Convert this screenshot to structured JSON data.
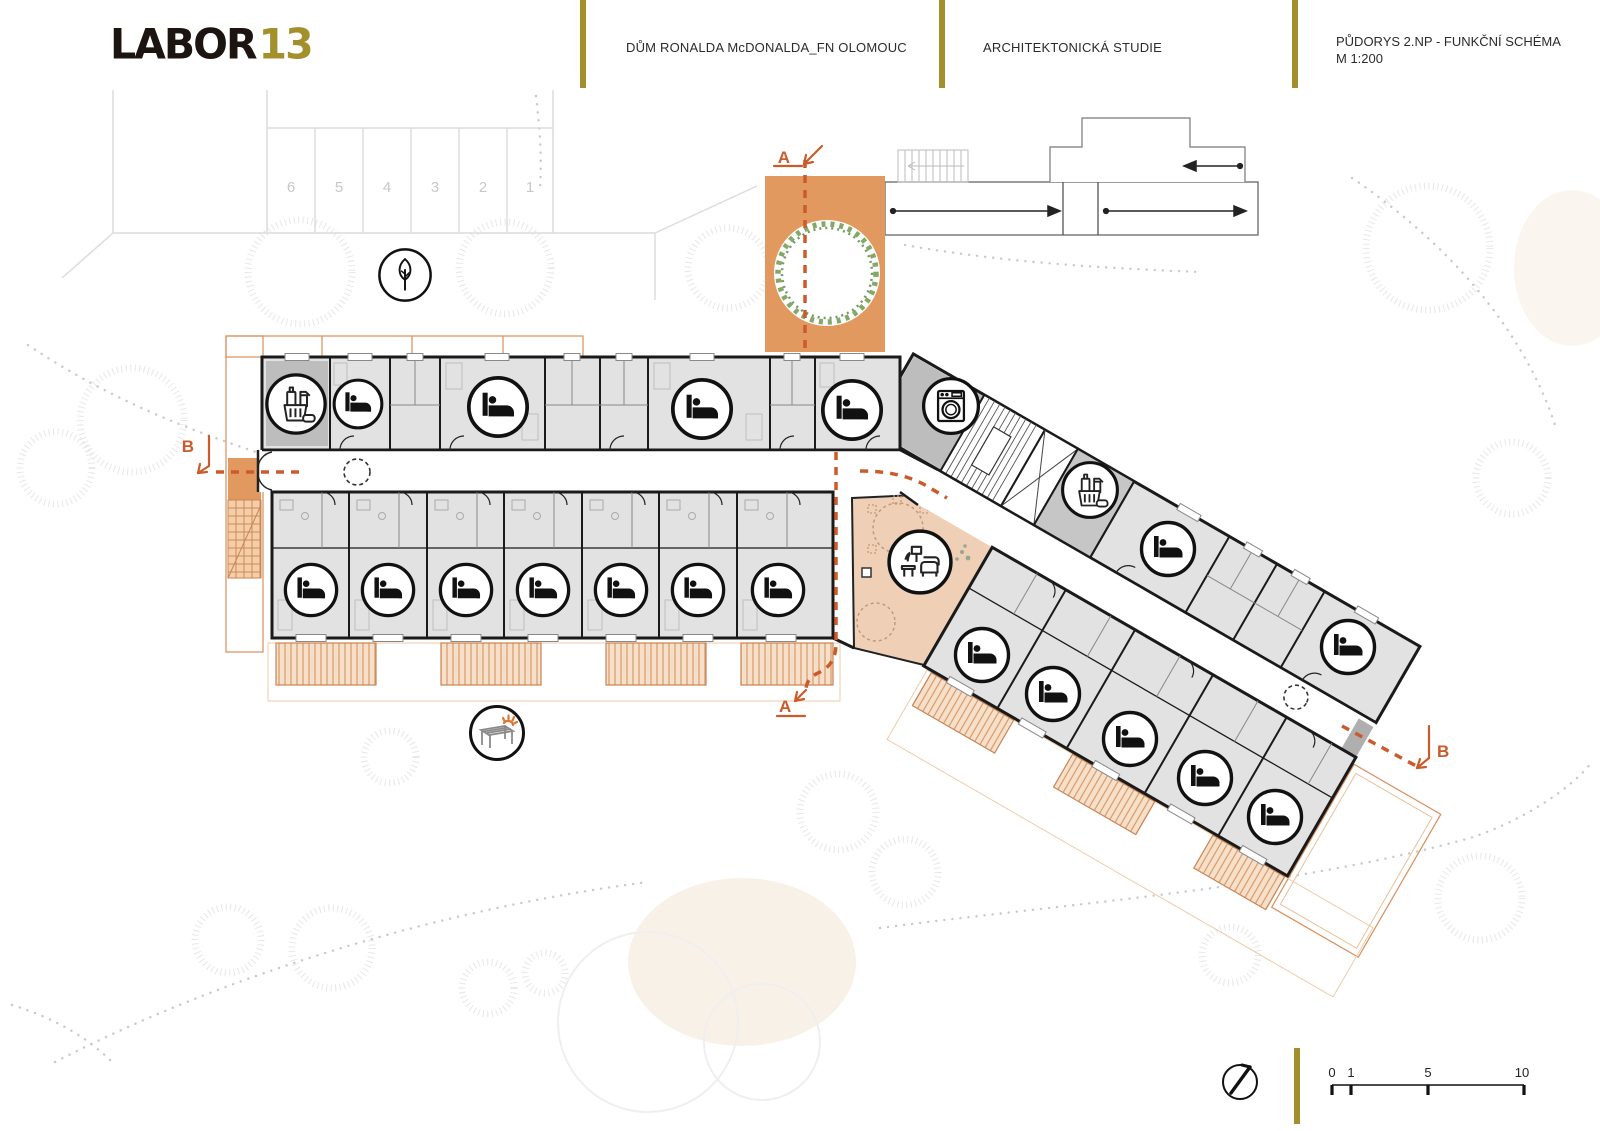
{
  "header": {
    "logo_primary": "LABOR",
    "logo_accent": "13",
    "project_title": "DŮM RONALDA McDONALDA_FN OLOMOUC",
    "stage_title": "ARCHITEKTONICKÁ STUDIE",
    "drawing_title": "PŮDORYS 2.NP - FUNKČNÍ SCHÉMA",
    "drawing_scale": "M 1:200"
  },
  "site": {
    "parking_numbers": [
      "6",
      "5",
      "4",
      "3",
      "2",
      "1"
    ]
  },
  "sections": {
    "a_top": "A",
    "a_bottom": "A",
    "b_left": "B",
    "b_right": "B"
  },
  "scale_bar": {
    "labels": [
      "0",
      "1",
      "5",
      "10"
    ]
  },
  "icons": {
    "bed": "bed-icon",
    "cleaning": "cleaning-supplies-icon",
    "laundry": "washing-machine-icon",
    "lounge": "lounge-seating-icon",
    "tree": "tree-icon",
    "pergola": "pergola-icon",
    "north": "north-arrow-icon"
  },
  "plan_summary": {
    "bedrooms_left_wing": 11,
    "bedrooms_right_wing": 7,
    "housekeeping_rooms": 2,
    "laundry_rooms": 1,
    "lounge_areas": 1,
    "parking_spaces": 6
  },
  "colors": {
    "accent_olive": "#A3902C",
    "terrace_orange": "#E2995F",
    "balcony_fill": "#F7E0CA",
    "balcony_line": "#D79A6A",
    "lounge_peach": "#EFD0B6",
    "section_orange": "#CC5B2B",
    "room_gray": "#E2E2E2",
    "service_gray": "#BDBDBD",
    "wall_black": "#1A1A1A",
    "tree_green": "#6F9A4B"
  }
}
